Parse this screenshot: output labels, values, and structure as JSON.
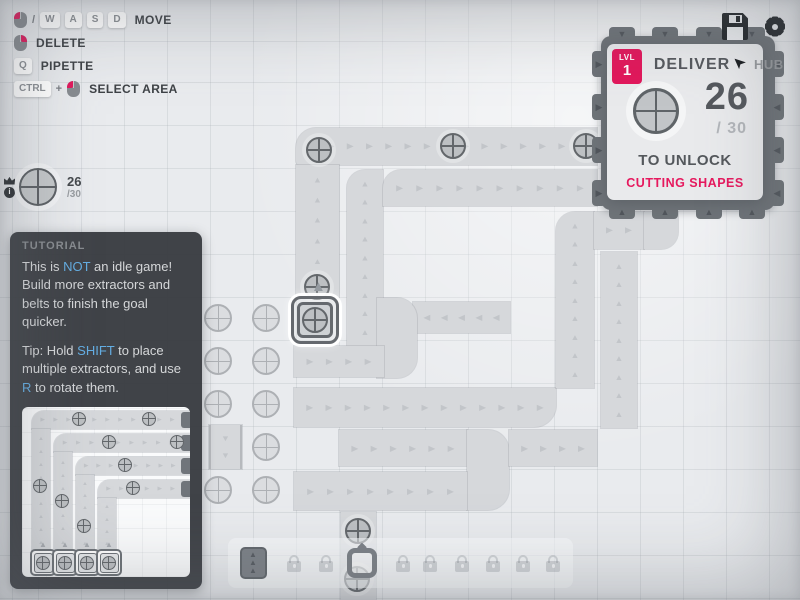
{
  "colors": {
    "accent": "#e2175b",
    "link": "#64aee3",
    "belt": "#d6d8db",
    "hub": "#6e7378",
    "background": "#e9ebee",
    "dark_icon": "#23272b"
  },
  "topbar": {
    "icons": [
      "save-icon",
      "settings-icon"
    ]
  },
  "hints": {
    "rows": [
      {
        "items": [
          {
            "type": "mouse",
            "button": "left"
          },
          {
            "type": "sep",
            "text": "/"
          },
          {
            "type": "key",
            "text": "W"
          },
          {
            "type": "key",
            "text": "A"
          },
          {
            "type": "key",
            "text": "S"
          },
          {
            "type": "key",
            "text": "D"
          }
        ],
        "label": "MOVE"
      },
      {
        "items": [
          {
            "type": "mouse",
            "button": "right"
          }
        ],
        "label": "DELETE"
      },
      {
        "items": [
          {
            "type": "key",
            "text": "Q"
          }
        ],
        "label": "PIPETTE"
      },
      {
        "items": [
          {
            "type": "key",
            "text": "CTRL"
          },
          {
            "type": "sep",
            "text": "+"
          },
          {
            "type": "mouse",
            "button": "left"
          }
        ],
        "label": "SELECT AREA"
      }
    ]
  },
  "pinned_goal": {
    "current": "26",
    "total": "/30",
    "icons": [
      "crown-icon",
      "info-icon"
    ],
    "shape": "circle"
  },
  "hub_panel": {
    "level_label": "LVL",
    "level": "1",
    "title": "DELIVER",
    "hub_label": "HUB",
    "pin_icon": "cursor-icon",
    "amount": "26",
    "goal_total": "/ 30",
    "shape": "circle",
    "unlock_text": "TO UNLOCK",
    "reward": "CUTTING SHAPES"
  },
  "tutorial": {
    "title": "TUTORIAL",
    "paragraphs": [
      [
        {
          "t": "This is "
        },
        {
          "t": "NOT",
          "hl": true
        },
        {
          "t": " an idle game! Build more extractors and belts to finish the goal quicker."
        }
      ],
      [
        {
          "t": "Tip: Hold "
        },
        {
          "t": "SHIFT",
          "hl": true
        },
        {
          "t": " to place multiple extractors, and use "
        },
        {
          "t": "R",
          "hl": true
        },
        {
          "t": " to rotate them."
        }
      ]
    ],
    "image_board": {
      "belts": [
        {
          "x": 10,
          "y": 4,
          "w": 164,
          "h": 18,
          "dir": "right",
          "rad": "12px 0 0 0"
        },
        {
          "x": 10,
          "y": 22,
          "w": 18,
          "h": 124,
          "dir": "up"
        },
        {
          "x": 32,
          "y": 27,
          "w": 142,
          "h": 18,
          "dir": "right",
          "rad": "12px 0 0 0"
        },
        {
          "x": 32,
          "y": 45,
          "w": 18,
          "h": 101,
          "dir": "up"
        },
        {
          "x": 54,
          "y": 50,
          "w": 120,
          "h": 18,
          "dir": "right",
          "rad": "12px 0 0 0"
        },
        {
          "x": 54,
          "y": 68,
          "w": 18,
          "h": 78,
          "dir": "up"
        },
        {
          "x": 76,
          "y": 73,
          "w": 98,
          "h": 18,
          "dir": "right",
          "rad": "12px 0 0 0"
        },
        {
          "x": 76,
          "y": 91,
          "w": 18,
          "h": 55,
          "dir": "up"
        }
      ],
      "hub_tabs": [
        [
          159,
          5
        ],
        [
          159,
          28
        ],
        [
          159,
          51
        ],
        [
          159,
          74
        ]
      ],
      "shapes": [
        [
          58,
          13
        ],
        [
          128,
          13
        ],
        [
          88,
          36
        ],
        [
          156,
          36
        ],
        [
          104,
          59
        ],
        [
          112,
          82
        ],
        [
          19,
          80
        ],
        [
          41,
          95
        ],
        [
          63,
          120
        ]
      ],
      "extractors": [
        [
          8,
          142
        ],
        [
          30,
          142
        ],
        [
          52,
          142
        ],
        [
          74,
          142
        ]
      ]
    }
  },
  "toolbar": {
    "slots": [
      {
        "kind": "belt",
        "cx": 25
      },
      {
        "kind": "lock",
        "cx": 66
      },
      {
        "kind": "lock",
        "cx": 98
      },
      {
        "kind": "miner",
        "cx": 134
      },
      {
        "kind": "lock",
        "cx": 175
      },
      {
        "kind": "lock",
        "cx": 202
      },
      {
        "kind": "lock",
        "cx": 234
      },
      {
        "kind": "lock",
        "cx": 265
      },
      {
        "kind": "lock",
        "cx": 295
      },
      {
        "kind": "lock",
        "cx": 325
      }
    ]
  },
  "board": {
    "hub": {
      "x": 601,
      "y": 36,
      "w": 174,
      "h": 174,
      "tabs": {
        "top": [
          622,
          665,
          709,
          752
        ],
        "bottom": [
          622,
          665,
          709,
          752
        ],
        "left": [
          64,
          107,
          150,
          193
        ],
        "right": [
          64,
          107,
          150,
          193
        ]
      }
    },
    "belts": [
      {
        "x": 296,
        "y": 128,
        "w": 301,
        "h": 37,
        "dir": "right",
        "rad": "20px 0 0 4px"
      },
      {
        "x": 296,
        "y": 165,
        "w": 43,
        "h": 132,
        "dir": "up"
      },
      {
        "x": 347,
        "y": 170,
        "w": 36,
        "h": 176,
        "dir": "up",
        "rad": "18px 0 0 0"
      },
      {
        "x": 383,
        "y": 170,
        "w": 214,
        "h": 36,
        "dir": "right",
        "rad": "18px 0 0 0"
      },
      {
        "x": 413,
        "y": 302,
        "w": 97,
        "h": 31,
        "dir": "left"
      },
      {
        "x": 377,
        "y": 298,
        "w": 40,
        "h": 80,
        "rad": "0 20px 20px 0"
      },
      {
        "x": 294,
        "y": 346,
        "w": 90,
        "h": 31,
        "dir": "right"
      },
      {
        "x": 294,
        "y": 388,
        "w": 262,
        "h": 39,
        "dir": "right",
        "rad": "0 0 22px 0"
      },
      {
        "x": 556,
        "y": 212,
        "w": 38,
        "h": 176,
        "dir": "up",
        "rad": "19px 0 0 0"
      },
      {
        "x": 594,
        "y": 212,
        "w": 50,
        "h": 37,
        "dir": "right"
      },
      {
        "x": 644,
        "y": 212,
        "w": 34,
        "h": 37,
        "rad": "0 0 17px 0"
      },
      {
        "x": 601,
        "y": 252,
        "w": 36,
        "h": 176,
        "dir": "up"
      },
      {
        "x": 339,
        "y": 430,
        "w": 128,
        "h": 36,
        "dir": "right"
      },
      {
        "x": 467,
        "y": 430,
        "w": 42,
        "h": 80,
        "rad": "0 21px 21px 0"
      },
      {
        "x": 509,
        "y": 430,
        "w": 88,
        "h": 36,
        "dir": "right"
      },
      {
        "x": 294,
        "y": 472,
        "w": 173,
        "h": 38,
        "dir": "right"
      },
      {
        "x": 341,
        "y": 512,
        "w": 35,
        "h": 88
      },
      {
        "x": 209,
        "y": 425,
        "w": 33,
        "h": 44,
        "dir": "down",
        "edge": true
      }
    ],
    "deposits": [
      [
        218,
        318
      ],
      [
        218,
        361
      ],
      [
        218,
        404
      ],
      [
        218,
        490
      ],
      [
        266,
        318
      ],
      [
        266,
        361
      ],
      [
        266,
        404
      ],
      [
        266,
        447
      ],
      [
        266,
        490
      ]
    ],
    "shapes": [
      [
        319,
        150
      ],
      [
        453,
        146
      ],
      [
        586,
        146
      ],
      [
        317,
        287
      ],
      [
        358,
        531
      ],
      [
        357,
        579
      ]
    ],
    "extractor": {
      "x": 291,
      "y": 296,
      "size": 54
    }
  }
}
